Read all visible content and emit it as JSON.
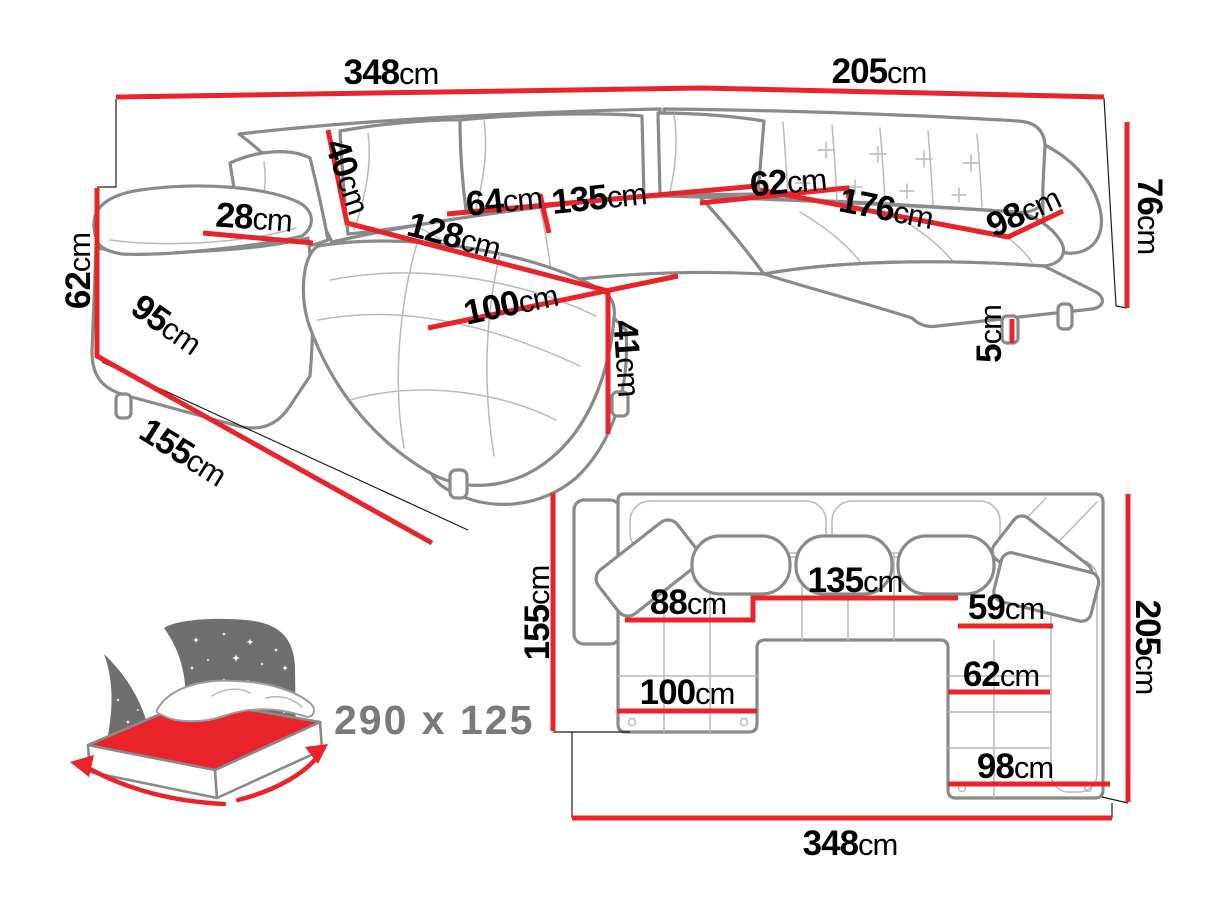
{
  "colors": {
    "dimension_red": "#e8242a",
    "sofa_outline_gray": "#8a8a8a",
    "headboard_gray": "#6f6f6f",
    "sleeping_text_gray": "#7a7a7a",
    "label_black": "#000000"
  },
  "perspective_view": {
    "dimensions": [
      {
        "name": "back-total-width",
        "value": "348",
        "unit": "cm"
      },
      {
        "name": "right-total-width",
        "value": "205",
        "unit": "cm"
      },
      {
        "name": "total-height",
        "value": "76",
        "unit": "cm"
      },
      {
        "name": "armrest-height",
        "value": "62",
        "unit": "cm"
      },
      {
        "name": "left-total-depth",
        "value": "155",
        "unit": "cm"
      },
      {
        "name": "armrest-top-width",
        "value": "28",
        "unit": "cm"
      },
      {
        "name": "backrest-cushion-height",
        "value": "40",
        "unit": "cm"
      },
      {
        "name": "seat-depth",
        "value": "64",
        "unit": "cm"
      },
      {
        "name": "middle-seat-width",
        "value": "135",
        "unit": "cm"
      },
      {
        "name": "chaise-length",
        "value": "128",
        "unit": "cm"
      },
      {
        "name": "chaise-width",
        "value": "100",
        "unit": "cm"
      },
      {
        "name": "seat-height",
        "value": "41",
        "unit": "cm"
      },
      {
        "name": "armrest-side-length",
        "value": "95",
        "unit": "cm"
      },
      {
        "name": "right-seat-depth",
        "value": "62",
        "unit": "cm"
      },
      {
        "name": "right-seat-length",
        "value": "176",
        "unit": "cm"
      },
      {
        "name": "right-end-width",
        "value": "98",
        "unit": "cm"
      },
      {
        "name": "leg-height",
        "value": "5",
        "unit": "cm"
      }
    ]
  },
  "plan_view": {
    "dimensions": [
      {
        "name": "plan-left-depth",
        "value": "155",
        "unit": "cm"
      },
      {
        "name": "plan-right-depth",
        "value": "205",
        "unit": "cm"
      },
      {
        "name": "plan-total-width",
        "value": "348",
        "unit": "cm"
      },
      {
        "name": "plan-chaise-inner",
        "value": "88",
        "unit": "cm"
      },
      {
        "name": "plan-middle-seat",
        "value": "135",
        "unit": "cm"
      },
      {
        "name": "plan-right-inner",
        "value": "59",
        "unit": "cm"
      },
      {
        "name": "plan-right-seat",
        "value": "62",
        "unit": "cm"
      },
      {
        "name": "plan-chaise-width",
        "value": "100",
        "unit": "cm"
      },
      {
        "name": "plan-right-width",
        "value": "98",
        "unit": "cm"
      }
    ]
  },
  "sleeping_function": {
    "size_label": "290 x 125"
  }
}
